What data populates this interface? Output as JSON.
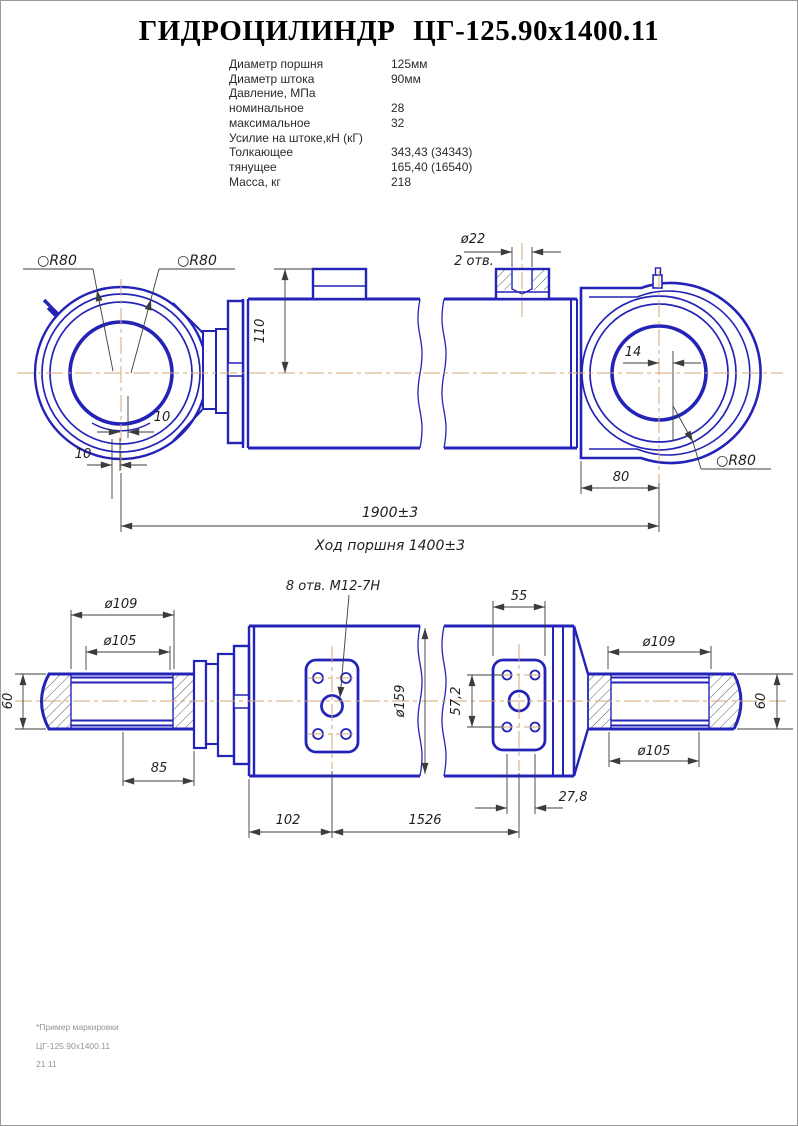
{
  "page": {
    "title": "ГИДРОЦИЛИНДР ЦГ-125.90х1400.11"
  },
  "specs": {
    "rows": [
      {
        "label": "Диаметр поршня",
        "value": "125мм"
      },
      {
        "label": "Диаметр штока",
        "value": "90мм"
      },
      {
        "label": "Давление, МПа",
        "value": ""
      },
      {
        "label": "номинальное",
        "value": "28"
      },
      {
        "label": "максимальное",
        "value": "32"
      },
      {
        "label": "Усилие на штоке,кН (кГ)",
        "value": ""
      },
      {
        "label": "Толкающее",
        "value": "343,43 (34343)"
      },
      {
        "label": "тянущее",
        "value": "165,40 (16540)"
      },
      {
        "label": "Масса,  кг",
        "value": "218"
      }
    ]
  },
  "top_view": {
    "sphere_r_left_outer": "○R80",
    "sphere_r_left_inner": "○R80",
    "sphere_r_right": "○R80",
    "hole_dia": "ø22",
    "hole_count": "2 отв.",
    "dim_port_height": "110",
    "dim_eye_offset_right": "14",
    "dim_offset_inner": "10",
    "dim_offset_outer": "10",
    "dim_head_to_eye": "80",
    "dim_total_length": "1900±3",
    "dim_stroke": "Ход поршня 1400±3"
  },
  "bottom_view": {
    "dia_thread_outer_left": "ø109",
    "dia_thread_inner_left": "ø105",
    "dim_rod_dia_left": "60",
    "dim_thread_length": "85",
    "thread_label": "8 отв. М12-7Н",
    "dia_body": "ø159",
    "dim_flange_width": "55",
    "dim_hole_spacing_v": "57,2",
    "dia_thread_outer_right": "ø109",
    "dia_thread_inner_right": "ø105",
    "dim_rod_dia_right": "60",
    "dim_port1_offset": "102",
    "dim_port_distance": "1526",
    "dim_port2_offset": "27,8"
  },
  "footnote": {
    "line1": "*Пример маркировки",
    "line2": "ЦГ-125.90х1400.11",
    "line3": "21 11"
  },
  "colors": {
    "drawing_line": "#2323b8",
    "centerline": "#d2a878",
    "dimension_line": "#3c3c3c",
    "page_border": "#9a9a9a",
    "footnote_text": "#97948f"
  }
}
